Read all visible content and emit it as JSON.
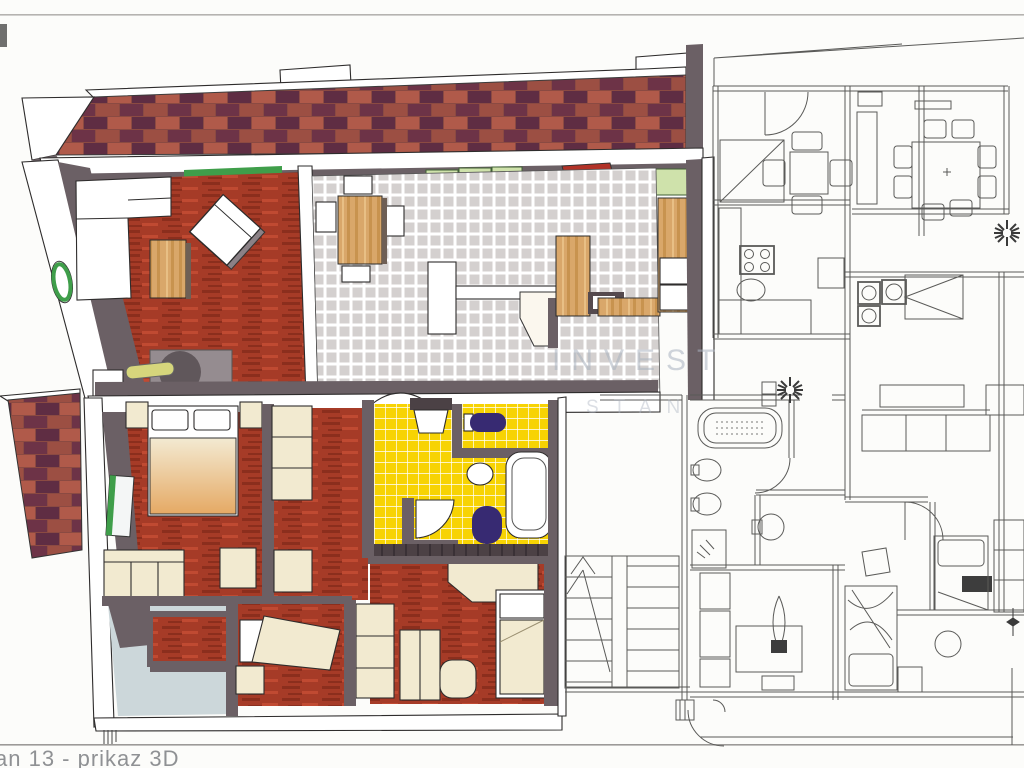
{
  "page": {
    "caption": "an 13 - prikaz 3D",
    "watermark_line1": "INVEST",
    "watermark_line2": "STAN"
  },
  "palette": {
    "paper": "#fcfcfa",
    "ink": "#2e2c2c",
    "plan_line": "#5a5a58",
    "scanline_gray": "#b5b3b0",
    "separator_gray": "#9c9a98",
    "caption_gray": "#8f9194",
    "watermark_gray": "#aab3c0",
    "wall_gray": "#6b6065",
    "roof_base": "#8b4a42",
    "roof_red": "#9c4f43",
    "roof_maroon": "#6d3347",
    "roof_light": "#b05a4a",
    "roof_purple": "#5f2d43",
    "floor_red": "#a63b27",
    "floor_red_dark": "#8b2e1d",
    "floor_red_light": "#c04a32",
    "tile_gray": "#d4d0cf",
    "bath_yellow": "#f7d303",
    "fixture_purple": "#372a72",
    "cream": "#f2ead0",
    "blanket_tan": "#e5a964",
    "wood": "#d9a76a",
    "wood_dark": "#c8934f",
    "wood_light": "#e8bf85",
    "pale_green": "#cfe2ab",
    "accent_green": "#3f9e4a",
    "hall_blue": "#ccd7da",
    "walkway_brown": "#4c4145"
  }
}
